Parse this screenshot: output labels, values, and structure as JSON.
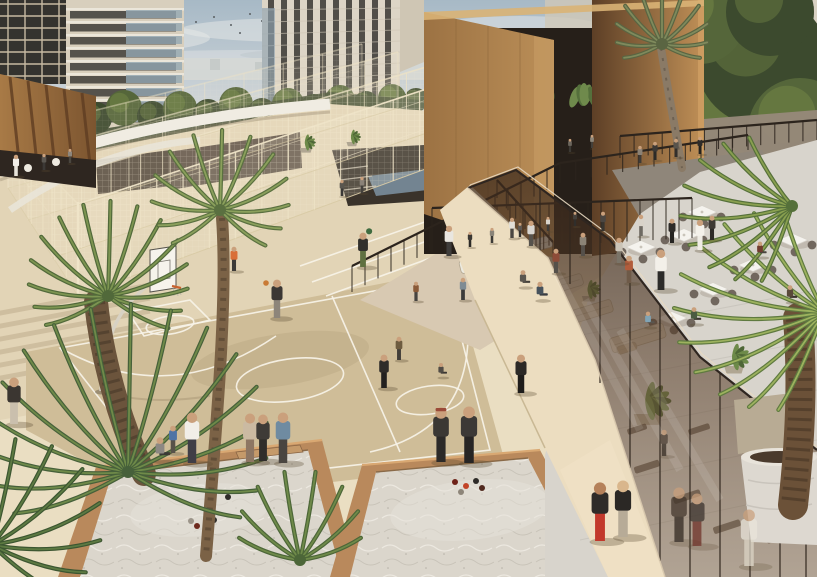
{
  "meta": {
    "title": "Architectural rendering: residential sports and leisure deck"
  },
  "scene": {
    "alt": "Aerial rendering of a residential podium deck with fenced padel courts, a basketball court, two sand petanque pits, a glass-roofed gym, an outdoor restaurant terrace, palm trees and many people",
    "palette": {
      "sky1": "#a7b9c6",
      "sky2": "#c9d1d6",
      "sky3": "#e3e2da",
      "cloud": "#e8e9e8",
      "treeL": "#8aa050",
      "treeM": "#55663a",
      "treeD": "#3c4a2e",
      "horizon": "#d5d8d5",
      "bldg": "#d8cfbd",
      "bldgWin": "#3e3c38",
      "glassBlue": "#93a7b3",
      "bronzeL": "#bb8f58",
      "bronzeM": "#9c7243",
      "bronzeD": "#5d3f26",
      "louv": "#a87a46",
      "louvD": "#7c5530",
      "recess": "#261f19",
      "whiteEdge": "#f0ece2",
      "ground": "#e2d4b6",
      "plaza": "#e9dfc8",
      "walk": "#ecddc0",
      "court": "#cfbd98",
      "courtLine": "#f7f3e8",
      "fence": "#eee3c6",
      "fenceLo": "#d9cba6",
      "railDark": "#2c241d",
      "sand": "#dbd6cc",
      "rim": "#b9895c",
      "rimHi": "#d9a872",
      "terrace": "#d8d4cc",
      "awning": "#8f867a",
      "sofa": "#d4c8b4",
      "chair": "#6b6157",
      "tableWhite": "#f5f3ee",
      "glassTint": "#43301f",
      "mullion": "#32281f",
      "skin": "#caa07c",
      "shadow": "#5b4a33",
      "trunk": "#6b543c",
      "water": "#7e93a3",
      "pot": "#ddd8d0"
    },
    "birds": [
      [
        196,
        22
      ],
      [
        214,
        17
      ],
      [
        231,
        25
      ],
      [
        250,
        14
      ],
      [
        262,
        21
      ],
      [
        279,
        12
      ],
      [
        292,
        19
      ],
      [
        176,
        30
      ],
      [
        240,
        33
      ],
      [
        308,
        16
      ],
      [
        120,
        12
      ],
      [
        98,
        17
      ]
    ],
    "trees": [
      {
        "x": 12,
        "y": 112,
        "r": 18
      },
      {
        "x": 38,
        "y": 120,
        "r": 15
      },
      {
        "x": 66,
        "y": 112,
        "r": 17
      },
      {
        "x": 96,
        "y": 118,
        "r": 16
      },
      {
        "x": 124,
        "y": 108,
        "r": 18
      },
      {
        "x": 152,
        "y": 116,
        "r": 15
      },
      {
        "x": 180,
        "y": 108,
        "r": 17
      },
      {
        "x": 208,
        "y": 114,
        "r": 15
      },
      {
        "x": 236,
        "y": 104,
        "r": 17
      },
      {
        "x": 262,
        "y": 112,
        "r": 14
      },
      {
        "x": 288,
        "y": 104,
        "r": 16
      },
      {
        "x": 314,
        "y": 108,
        "r": 14
      },
      {
        "x": 340,
        "y": 100,
        "r": 15
      },
      {
        "x": 366,
        "y": 104,
        "r": 13
      },
      {
        "x": 392,
        "y": 98,
        "r": 14
      },
      {
        "x": 416,
        "y": 100,
        "r": 12
      },
      {
        "x": 436,
        "y": 96,
        "r": 11
      },
      {
        "x": 575,
        "y": 85,
        "r": 48
      },
      {
        "x": 620,
        "y": 130,
        "r": 55
      },
      {
        "x": 668,
        "y": 70,
        "r": 62
      },
      {
        "x": 715,
        "y": 125,
        "r": 58
      },
      {
        "x": 762,
        "y": 60,
        "r": 66
      },
      {
        "x": 800,
        "y": 130,
        "r": 52
      },
      {
        "x": 640,
        "y": 25,
        "r": 40
      },
      {
        "x": 700,
        "y": 18,
        "r": 46
      },
      {
        "x": 770,
        "y": 12,
        "r": 44
      },
      {
        "x": 595,
        "y": 170,
        "r": 36
      },
      {
        "x": 680,
        "y": 178,
        "r": 40
      },
      {
        "x": 745,
        "y": 182,
        "r": 38
      },
      {
        "x": 812,
        "y": 185,
        "r": 36
      }
    ],
    "fences": [
      {
        "x1": 78,
        "y1": 296,
        "x2": 472,
        "y2": 152,
        "h1": 92,
        "h2": 78,
        "n": 15,
        "op": 0.95
      },
      {
        "x1": 52,
        "y1": 258,
        "x2": 436,
        "y2": 130,
        "h1": 78,
        "h2": 66,
        "n": 13,
        "op": 0.75
      },
      {
        "x1": 28,
        "y1": 220,
        "x2": 398,
        "y2": 108,
        "h1": 66,
        "h2": 56,
        "n": 11,
        "op": 0.6
      },
      {
        "x1": 8,
        "y1": 188,
        "x2": 362,
        "y2": 92,
        "h1": 56,
        "h2": 48,
        "n": 9,
        "op": 0.45
      },
      {
        "x1": 438,
        "y1": 298,
        "x2": 472,
        "y2": 152,
        "h1": 86,
        "h2": 80,
        "n": 7,
        "op": 0.85
      },
      {
        "x1": 78,
        "y1": 296,
        "x2": 8,
        "y2": 188,
        "h1": 92,
        "h2": 56,
        "n": 6,
        "op": 0.6
      },
      {
        "x1": 470,
        "y1": 152,
        "x2": 560,
        "y2": 122,
        "h1": 80,
        "h2": 72,
        "n": 5,
        "op": 0.7
      }
    ],
    "rails": [
      {
        "x1": 352,
        "y1": 292,
        "x2": 560,
        "y2": 183,
        "h1": 26,
        "h2": 20,
        "n": 16
      },
      {
        "x1": 560,
        "y1": 183,
        "x2": 748,
        "y2": 150,
        "h1": 20,
        "h2": 15,
        "n": 12
      },
      {
        "x1": 497,
        "y1": 198,
        "x2": 553,
        "y2": 260,
        "h1": 18,
        "h2": 18,
        "n": 6
      },
      {
        "x1": 620,
        "y1": 158,
        "x2": 817,
        "y2": 140,
        "h1": 22,
        "h2": 20,
        "n": 14
      },
      {
        "x1": 432,
        "y1": 252,
        "x2": 692,
        "y2": 238,
        "h1": 44,
        "h2": 40,
        "n": 20
      }
    ],
    "glassPosts": [
      [
        540,
        188,
        251
      ],
      [
        570,
        203,
        284
      ],
      [
        600,
        233,
        383
      ],
      [
        630,
        266,
        468
      ],
      [
        660,
        305,
        561
      ],
      [
        690,
        344,
        577
      ],
      [
        720,
        373,
        577
      ],
      [
        750,
        397,
        577
      ],
      [
        780,
        421,
        577
      ],
      [
        806,
        441,
        577
      ]
    ],
    "gym": [
      {
        "x": 648,
        "y": 470,
        "w": 26,
        "h": 7,
        "r": -18
      },
      {
        "x": 688,
        "y": 500,
        "w": 28,
        "h": 7,
        "r": -18
      },
      {
        "x": 728,
        "y": 530,
        "w": 28,
        "h": 7,
        "r": -18
      },
      {
        "x": 700,
        "y": 432,
        "w": 22,
        "h": 6,
        "r": -18
      },
      {
        "x": 760,
        "y": 472,
        "w": 24,
        "h": 6,
        "r": -18
      },
      {
        "x": 638,
        "y": 432,
        "w": 20,
        "h": 6,
        "r": -18
      },
      {
        "x": 780,
        "y": 540,
        "w": 26,
        "h": 7,
        "r": -18
      }
    ],
    "tables": [
      {
        "x": 641,
        "y": 247
      },
      {
        "x": 684,
        "y": 235
      },
      {
        "x": 713,
        "y": 289
      },
      {
        "x": 753,
        "y": 265
      },
      {
        "x": 793,
        "y": 240
      },
      {
        "x": 672,
        "y": 318
      },
      {
        "x": 702,
        "y": 212
      }
    ],
    "sofas": [
      {
        "x": 592,
        "y": 318,
        "w": 46,
        "h": 13,
        "r": -17
      },
      {
        "x": 640,
        "y": 345,
        "w": 56,
        "h": 15,
        "r": -17
      },
      {
        "x": 566,
        "y": 290,
        "w": 38,
        "h": 12,
        "r": -17
      },
      {
        "x": 628,
        "y": 352,
        "w": 20,
        "h": 8,
        "r": -17,
        "c": "#bfae94"
      },
      {
        "x": 486,
        "y": 268,
        "w": 50,
        "h": 13,
        "r": -14,
        "c": "#eceadf"
      },
      {
        "x": 532,
        "y": 252,
        "w": 44,
        "h": 12,
        "r": -14,
        "c": "#e9e6db"
      }
    ],
    "planters": [
      {
        "x": 589,
        "y": 296,
        "r": 13
      },
      {
        "x": 648,
        "y": 414,
        "r": 26
      },
      {
        "x": 734,
        "y": 366,
        "r": 18
      },
      {
        "x": 757,
        "y": 448,
        "r": 30
      },
      {
        "x": 306,
        "y": 148,
        "r": 11
      },
      {
        "x": 352,
        "y": 142,
        "r": 10
      }
    ],
    "hang": [
      {
        "x": 452,
        "y": 84
      },
      {
        "x": 494,
        "y": 76
      },
      {
        "x": 540,
        "y": 82
      },
      {
        "x": 584,
        "y": 88
      },
      {
        "x": 630,
        "y": 94
      },
      {
        "x": 664,
        "y": 102
      }
    ],
    "palms": [
      {
        "cx": 108,
        "cy": 296,
        "r": 95,
        "n": 15,
        "a0": -205,
        "a1": 28,
        "lt": "#7d9551",
        "dk": "#51693a"
      },
      {
        "cx": 128,
        "cy": 472,
        "r": 168,
        "n": 17,
        "a0": -200,
        "a1": 22,
        "lt": "#6f8a49",
        "dk": "#46603a"
      },
      {
        "cx": -8,
        "cy": 545,
        "r": 118,
        "n": 9,
        "a0": -115,
        "a1": 35,
        "lt": "#5d7a42",
        "dk": "#3c5631"
      },
      {
        "cx": 220,
        "cy": 210,
        "r": 80,
        "n": 13,
        "a0": -215,
        "a1": 38,
        "lt": "#8ba05c",
        "dk": "#5a7040"
      },
      {
        "cx": 662,
        "cy": 44,
        "r": 56,
        "n": 11,
        "a0": -200,
        "a1": 20,
        "lt": "#7f8a5c",
        "dk": "#5a6542"
      },
      {
        "cx": 824,
        "cy": 312,
        "r": 150,
        "n": 11,
        "a0": 115,
        "a1": 248,
        "lt": "#9db25e",
        "dk": "#5f7a40"
      },
      {
        "cx": 792,
        "cy": 206,
        "r": 112,
        "n": 9,
        "a0": 112,
        "a1": 238,
        "lt": "#8aa050",
        "dk": "#55703a"
      },
      {
        "cx": 300,
        "cy": 560,
        "r": 90,
        "n": 8,
        "a0": -160,
        "a1": -20,
        "lt": "#6f8a49",
        "dk": "#4c6638"
      }
    ],
    "trunks": [
      {
        "d": "M96,302 C102,360 120,422 144,474",
        "w": 24,
        "c": "#6b543c"
      },
      {
        "d": "M222,218 C228,300 216,430 206,556",
        "w": 12,
        "c": "#7b6246"
      },
      {
        "d": "M661,48 C668,92 676,132 682,168",
        "w": 8,
        "c": "#8a7a66"
      },
      {
        "d": "M798,318 C803,382 800,442 793,505",
        "w": 30,
        "c": "#6b5138"
      }
    ],
    "balls": {
      "left": [
        {
          "x": 211,
          "y": 496,
          "c": "#5f2019"
        },
        {
          "x": 228,
          "y": 497,
          "c": "#2e2b28"
        },
        {
          "x": 191,
          "y": 521,
          "c": "#9c958a"
        },
        {
          "x": 197,
          "y": 526,
          "c": "#6e2a1e"
        },
        {
          "x": 214,
          "y": 520,
          "c": "#33302c"
        }
      ],
      "right": [
        {
          "x": 455,
          "y": 482,
          "c": "#6e2218"
        },
        {
          "x": 466,
          "y": 486,
          "c": "#c24428"
        },
        {
          "x": 476,
          "y": 481,
          "c": "#2e2b28"
        },
        {
          "x": 461,
          "y": 492,
          "c": "#8d8579"
        },
        {
          "x": 482,
          "y": 488,
          "c": "#50291e"
        }
      ],
      "court": [
        {
          "x": 266,
          "y": 283,
          "c": "#c97a35"
        }
      ]
    },
    "people": [
      {
        "x": 16,
        "y": 176,
        "h": 21,
        "top": "#f2efe8",
        "btm": "#e8e4da"
      },
      {
        "x": 44,
        "y": 170,
        "h": 16,
        "top": "#5a5650",
        "btm": "#3c3936"
      },
      {
        "x": 70,
        "y": 163,
        "h": 14,
        "top": "#8d867c",
        "btm": "#4a463f"
      },
      {
        "x": 342,
        "y": 196,
        "h": 16,
        "top": "#5a564f",
        "btm": "#3a3836"
      },
      {
        "x": 362,
        "y": 193,
        "h": 16,
        "top": "#8a8278",
        "btm": "#44413c"
      },
      {
        "x": 234,
        "y": 271,
        "h": 24,
        "top": "#d96f38",
        "btm": "#3d3b38"
      },
      {
        "x": 363,
        "y": 267,
        "h": 34,
        "top": "#31302c",
        "btm": "#5f7040",
        "ball": "#3f6b3f"
      },
      {
        "x": 449,
        "y": 256,
        "h": 30,
        "top": "#e9e6e0",
        "btm": "#3f3d3b"
      },
      {
        "x": 531,
        "y": 246,
        "h": 25,
        "top": "#d9d5cf",
        "btm": "#56524c"
      },
      {
        "x": 512,
        "y": 238,
        "h": 20,
        "top": "#e2ded6",
        "btm": "#4a4641"
      },
      {
        "x": 416,
        "y": 301,
        "h": 19,
        "top": "#8a5a38",
        "btm": "#474440"
      },
      {
        "x": 463,
        "y": 300,
        "h": 22,
        "top": "#7e8b94",
        "btm": "#3b3b3b"
      },
      {
        "x": 277,
        "y": 318,
        "h": 38,
        "top": "#3b3734",
        "btm": "#8d857a"
      },
      {
        "x": 399,
        "y": 360,
        "h": 23,
        "top": "#6e5c40",
        "btm": "#423e38"
      },
      {
        "x": 384,
        "y": 388,
        "h": 33,
        "top": "#2f2c29",
        "btm": "#232120"
      },
      {
        "x": 441,
        "y": 377,
        "h": 20,
        "top": "#514c45",
        "btm": "#3a3632",
        "pose": "sit"
      },
      {
        "x": 521,
        "y": 393,
        "h": 38,
        "top": "#2c2926",
        "btm": "#1f1d1b"
      },
      {
        "x": 14,
        "y": 424,
        "h": 46,
        "top": "#3b3631",
        "btm": "#cabfad"
      },
      {
        "x": 160,
        "y": 461,
        "h": 34,
        "top": "#8d8883",
        "btm": "#3b3935",
        "pose": "sit"
      },
      {
        "x": 173,
        "y": 453,
        "h": 27,
        "top": "#4f74a5",
        "btm": "#575249"
      },
      {
        "x": 192,
        "y": 463,
        "h": 50,
        "top": "#f1eee7",
        "btm": "#403e46"
      },
      {
        "x": 250,
        "y": 462,
        "h": 48,
        "top": "#cbbaa2",
        "btm": "#8d7663"
      },
      {
        "x": 263,
        "y": 461,
        "h": 46,
        "top": "#3e3b37",
        "btm": "#2f2d2a"
      },
      {
        "x": 283,
        "y": 463,
        "h": 50,
        "top": "#6f8ba1",
        "btm": "#4a4540"
      },
      {
        "x": 441,
        "y": 462,
        "h": 54,
        "top": "#3b3834",
        "btm": "#2c2a28",
        "cap": "#9a4a38"
      },
      {
        "x": 469,
        "y": 463,
        "h": 56,
        "top": "#3c3936",
        "btm": "#272524"
      },
      {
        "x": 600,
        "y": 541,
        "h": 58,
        "top": "#2f2c29",
        "btm": "#c2392c",
        "skin": "#b5815a"
      },
      {
        "x": 623,
        "y": 537,
        "h": 56,
        "top": "#2b2825",
        "btm": "#b7ab97",
        "skin": "#d9b68c"
      },
      {
        "x": 679,
        "y": 542,
        "h": 54,
        "top": "#41342a",
        "btm": "#2e251e",
        "dim": true
      },
      {
        "x": 697,
        "y": 546,
        "h": 52,
        "top": "#38302b",
        "btm": "#6e2f26",
        "dim": true
      },
      {
        "x": 664,
        "y": 456,
        "h": 26,
        "top": "#4a3e33",
        "btm": "#352c24",
        "dim": true
      },
      {
        "x": 749,
        "y": 566,
        "h": 56,
        "top": "#eae5db",
        "btm": "#ded7c8",
        "dim": true
      },
      {
        "x": 661,
        "y": 290,
        "h": 40,
        "top": "#f3f0e9",
        "btm": "#2c2b29"
      },
      {
        "x": 648,
        "y": 327,
        "h": 22,
        "top": "#80a4b6",
        "btm": "#5a564f",
        "pose": "sit"
      },
      {
        "x": 694,
        "y": 324,
        "h": 24,
        "top": "#4b5c41",
        "btm": "#3a362f",
        "pose": "sit"
      },
      {
        "x": 629,
        "y": 283,
        "h": 27,
        "top": "#b25c3b",
        "btm": "#6e5a48"
      },
      {
        "x": 619,
        "y": 263,
        "h": 25,
        "top": "#cac3b6",
        "btm": "#7a7468"
      },
      {
        "x": 583,
        "y": 256,
        "h": 23,
        "top": "#8b8376",
        "btm": "#55504a"
      },
      {
        "x": 712,
        "y": 240,
        "h": 24,
        "top": "#3f3a35",
        "btm": "#2e2b28"
      },
      {
        "x": 760,
        "y": 257,
        "h": 22,
        "top": "#713c2f",
        "btm": "#4a453f",
        "pose": "sit"
      },
      {
        "x": 641,
        "y": 236,
        "h": 21,
        "top": "#d9d3c9",
        "btm": "#6e6a62"
      },
      {
        "x": 603,
        "y": 231,
        "h": 19,
        "top": "#4b4641",
        "btm": "#38352f"
      },
      {
        "x": 790,
        "y": 302,
        "h": 24,
        "top": "#5a4a3a",
        "btm": "#3a332c",
        "pose": "sit"
      },
      {
        "x": 700,
        "y": 250,
        "h": 30,
        "top": "#f4f1ea",
        "btm": "#efece4"
      },
      {
        "x": 672,
        "y": 243,
        "h": 24,
        "top": "#2e2b28",
        "btm": "#262421"
      },
      {
        "x": 523,
        "y": 287,
        "h": 24,
        "top": "#5c574f",
        "btm": "#44403a",
        "pose": "sit"
      },
      {
        "x": 556,
        "y": 273,
        "h": 24,
        "top": "#8d4b38",
        "btm": "#55504a"
      },
      {
        "x": 540,
        "y": 300,
        "h": 26,
        "top": "#47525c",
        "btm": "#3a3d42",
        "pose": "sit"
      },
      {
        "x": 470,
        "y": 247,
        "h": 15,
        "top": "#3a3733",
        "btm": "#2c2a27"
      },
      {
        "x": 492,
        "y": 243,
        "h": 15,
        "top": "#8a8478",
        "btm": "#3c3a36"
      },
      {
        "x": 520,
        "y": 237,
        "h": 14,
        "top": "#5c5650",
        "btm": "#34322f"
      },
      {
        "x": 548,
        "y": 231,
        "h": 14,
        "top": "#d9d4cb",
        "btm": "#3f3c38"
      },
      {
        "x": 575,
        "y": 226,
        "h": 14,
        "top": "#44403b",
        "btm": "#302e2b"
      },
      {
        "x": 640,
        "y": 163,
        "h": 17,
        "top": "#8a8175",
        "btm": "#3e3b37"
      },
      {
        "x": 655,
        "y": 160,
        "h": 18,
        "top": "#3c3834",
        "btm": "#2c2a27"
      },
      {
        "x": 676,
        "y": 157,
        "h": 18,
        "top": "#59544c",
        "btm": "#332f2b"
      },
      {
        "x": 700,
        "y": 154,
        "h": 17,
        "top": "#2f2c29",
        "btm": "#232220"
      },
      {
        "x": 570,
        "y": 152,
        "h": 13,
        "top": "#6b655c",
        "btm": "#3c3934"
      },
      {
        "x": 592,
        "y": 148,
        "h": 13,
        "top": "#8d867a",
        "btm": "#44403a"
      }
    ]
  }
}
